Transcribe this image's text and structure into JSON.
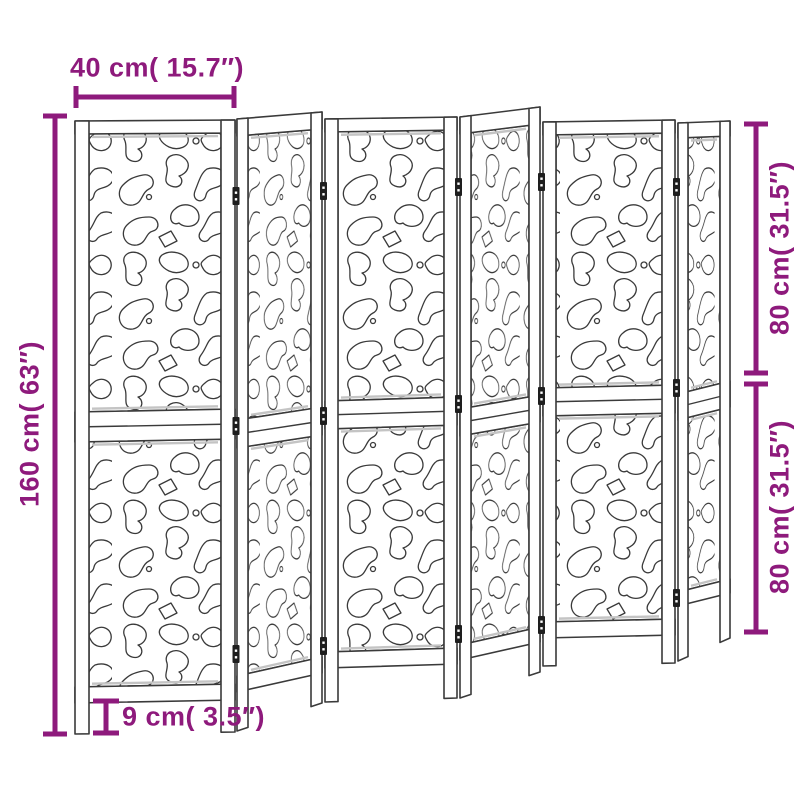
{
  "image_type": "product dimension diagram",
  "product": {
    "name": "6-panel decorative cutout room divider",
    "panel_count": 6
  },
  "dimensions": {
    "panel_width": "40 cm( 15.7″)",
    "total_height": "160 cm( 63″)",
    "upper_section_height": "80 cm( 31.5″)",
    "lower_section_height": "80 cm( 31.5″)",
    "leg_height": "9 cm( 3.5″)"
  },
  "colors": {
    "dimension_annotation": "#8E1A7C",
    "line_art": "#3A3A3A",
    "background": "#FFFFFF"
  }
}
